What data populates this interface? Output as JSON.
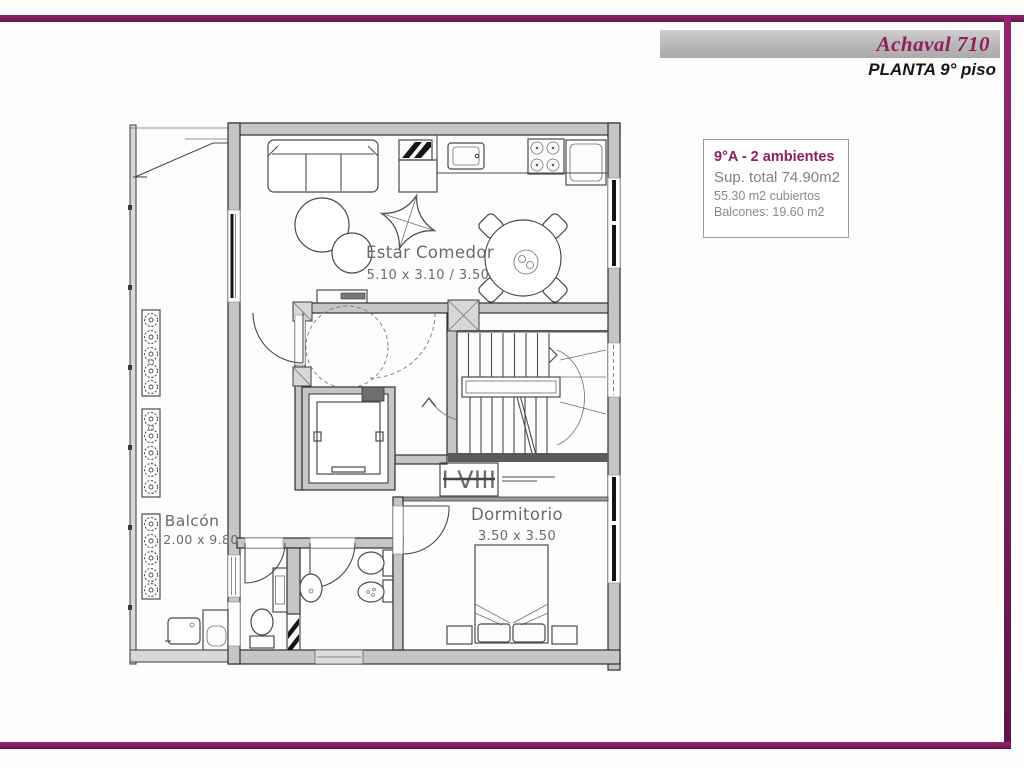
{
  "header": {
    "title": "Achaval 710",
    "subtitle": "PLANTA 9° piso"
  },
  "info_box": {
    "unit": "9°A -  2 ambientes",
    "sup_total": "Sup. total 74.90m2",
    "cubiertos": "55.30 m2 cubiertos",
    "balcones": "Balcones: 19.60 m2"
  },
  "plan": {
    "rooms": [
      {
        "name": "Estar Comedor",
        "dimensions": "5.10 x 3.10 / 3.50"
      },
      {
        "name": "Dormitorio",
        "dimensions": "3.50 x 3.50"
      },
      {
        "name": "Balcón",
        "dimensions": "2.00 x 9.80"
      }
    ],
    "stair_floor_label": "I VIII"
  },
  "colors": {
    "accent": "#7d1f5e",
    "wall_fill": "#c6c6c6",
    "label_gray": "#6b6b6b"
  }
}
